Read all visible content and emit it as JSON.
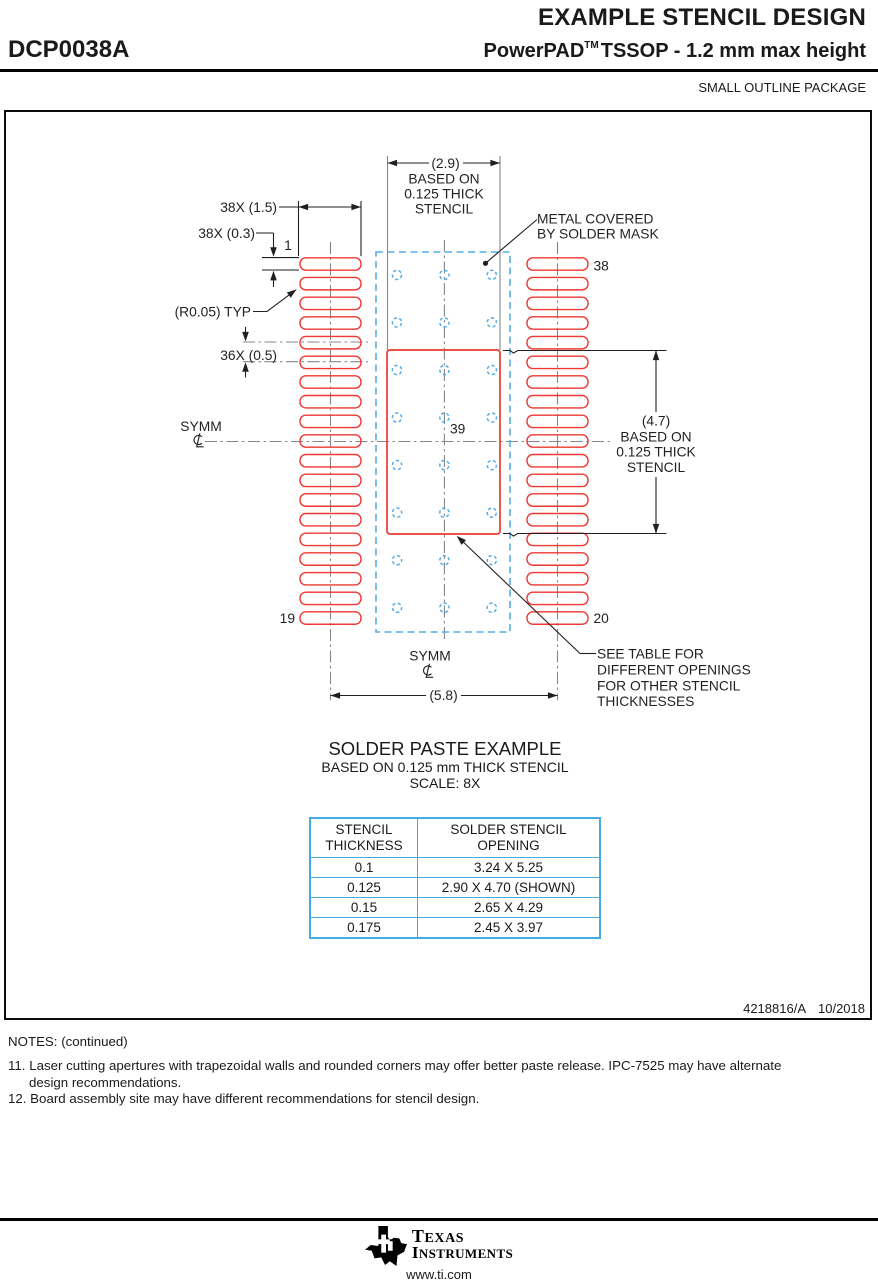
{
  "header": {
    "doc_title": "EXAMPLE STENCIL DESIGN",
    "part_number": "DCP0038A",
    "brand": "PowerPAD",
    "brand_tm": "TM",
    "package_desc": "TSSOP - 1.2 mm max height",
    "subtitle": "SMALL OUTLINE PACKAGE"
  },
  "drawing": {
    "dim_top_width": "(2.9)",
    "top_note": [
      "BASED ON",
      "0.125 THICK",
      "STENCIL"
    ],
    "dim_pad_height": "(4.7)",
    "right_note": [
      "BASED ON",
      "0.125 THICK",
      "STENCIL"
    ],
    "dim_aperture_width": "38X (1.5)",
    "dim_aperture_height": "38X (0.3)",
    "dim_pitch": "36X (0.5)",
    "dim_radius": "(R0.05) TYP",
    "dim_span": "(5.8)",
    "pin_first": "1",
    "pin_top_right": "38",
    "pin_bottom_left": "19",
    "pin_bottom_right": "20",
    "thermal_pad_number": "39",
    "symm_left": "SYMM",
    "symm_bottom": "SYMM",
    "metal_note": [
      "METAL COVERED",
      "BY SOLDER MASK"
    ],
    "see_table_note": [
      "SEE TABLE FOR",
      "DIFFERENT OPENINGS",
      "FOR OTHER STENCIL",
      "THICKNESSES"
    ],
    "caption_title": "SOLDER PASTE EXAMPLE",
    "caption_sub1": "BASED ON 0.125 mm THICK STENCIL",
    "caption_sub2": "SCALE: 8X"
  },
  "table": {
    "headers": [
      [
        "STENCIL",
        "THICKNESS"
      ],
      [
        "SOLDER STENCIL",
        "OPENING"
      ]
    ],
    "rows": [
      [
        "0.1",
        "3.24 X 5.25"
      ],
      [
        "0.125",
        "2.90 X 4.70 (SHOWN)"
      ],
      [
        "0.15",
        "2.65 X 4.29"
      ],
      [
        "0.175",
        "2.45 X 3.97"
      ]
    ]
  },
  "footer": {
    "doc_number": "4218816/A",
    "date": "10/2018",
    "notes_title": "NOTES: (continued)",
    "note11_line1": "11. Laser cutting apertures with trapezoidal walls and rounded corners may offer better paste release. IPC-7525 may have alternate",
    "note11_line2": "design recommendations.",
    "note12_line1": "12. Board assembly site may have different recommendations for stencil design.",
    "brand_line1": "TEXAS",
    "brand_line2": "INSTRUMENTS",
    "url": "www.ti.com"
  },
  "colors": {
    "red": "#ee3831",
    "blue": "#55ade6",
    "gray": "#85878a",
    "ink": "#231f20",
    "table_border": "#45ace2"
  }
}
